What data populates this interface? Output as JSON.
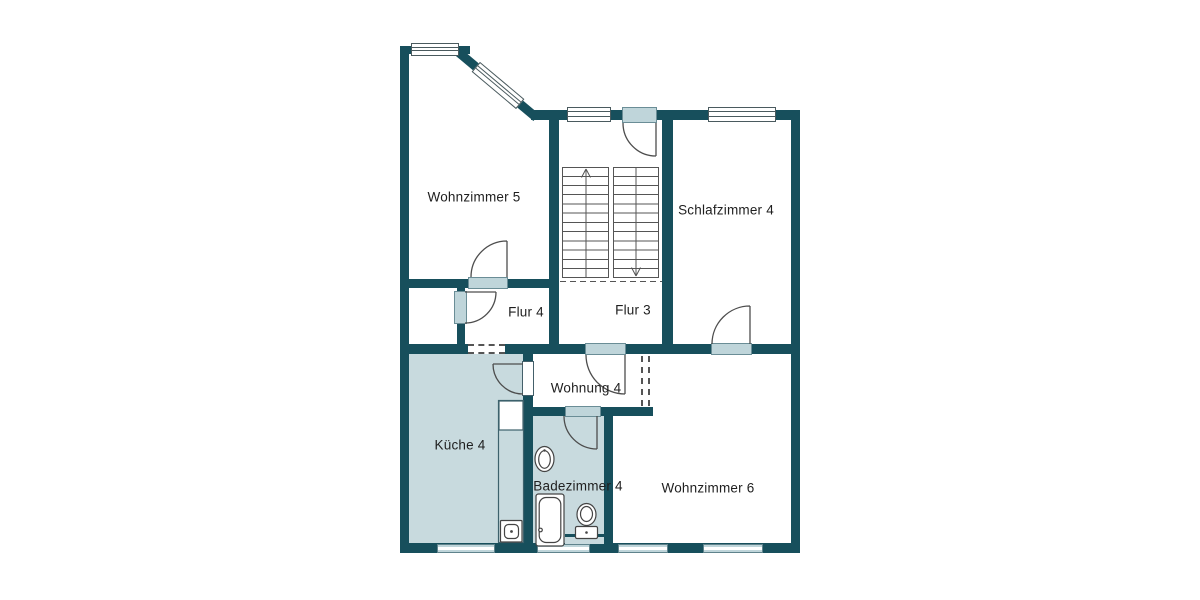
{
  "plan": {
    "type": "apartment-floor-plan",
    "language": "de",
    "rooms": [
      {
        "name": "wohnzimmer-5",
        "label": "Wohnzimmer 5",
        "shaded": false
      },
      {
        "name": "schlafzimmer-4",
        "label": "Schlafzimmer 4",
        "shaded": false
      },
      {
        "name": "flur-4",
        "label": "Flur 4",
        "shaded": false
      },
      {
        "name": "flur-3",
        "label": "Flur 3",
        "shaded": false
      },
      {
        "name": "wohnung-4",
        "label": "Wohnung 4",
        "shaded": false
      },
      {
        "name": "kueche-4",
        "label": "Küche 4",
        "shaded": true
      },
      {
        "name": "badezimmer-4",
        "label": "Badezimmer 4",
        "shaded": true
      },
      {
        "name": "wohnzimmer-6",
        "label": "Wohnzimmer 6",
        "shaded": false
      }
    ],
    "colors": {
      "wall": "#174f5c",
      "shaded_room_fill": "#c8dade",
      "window_sill": "#bfd5da",
      "line": "#4d4d4d",
      "background": "#ffffff"
    },
    "fixtures": [
      "stairs-icon",
      "stairs-up-arrow-icon",
      "stairs-down-arrow-icon",
      "kitchen-counter-icon",
      "kitchen-sink-icon",
      "bath-sink-icon",
      "bathtub-icon",
      "toilet-icon"
    ],
    "door_count": 7,
    "window_count": 8
  }
}
